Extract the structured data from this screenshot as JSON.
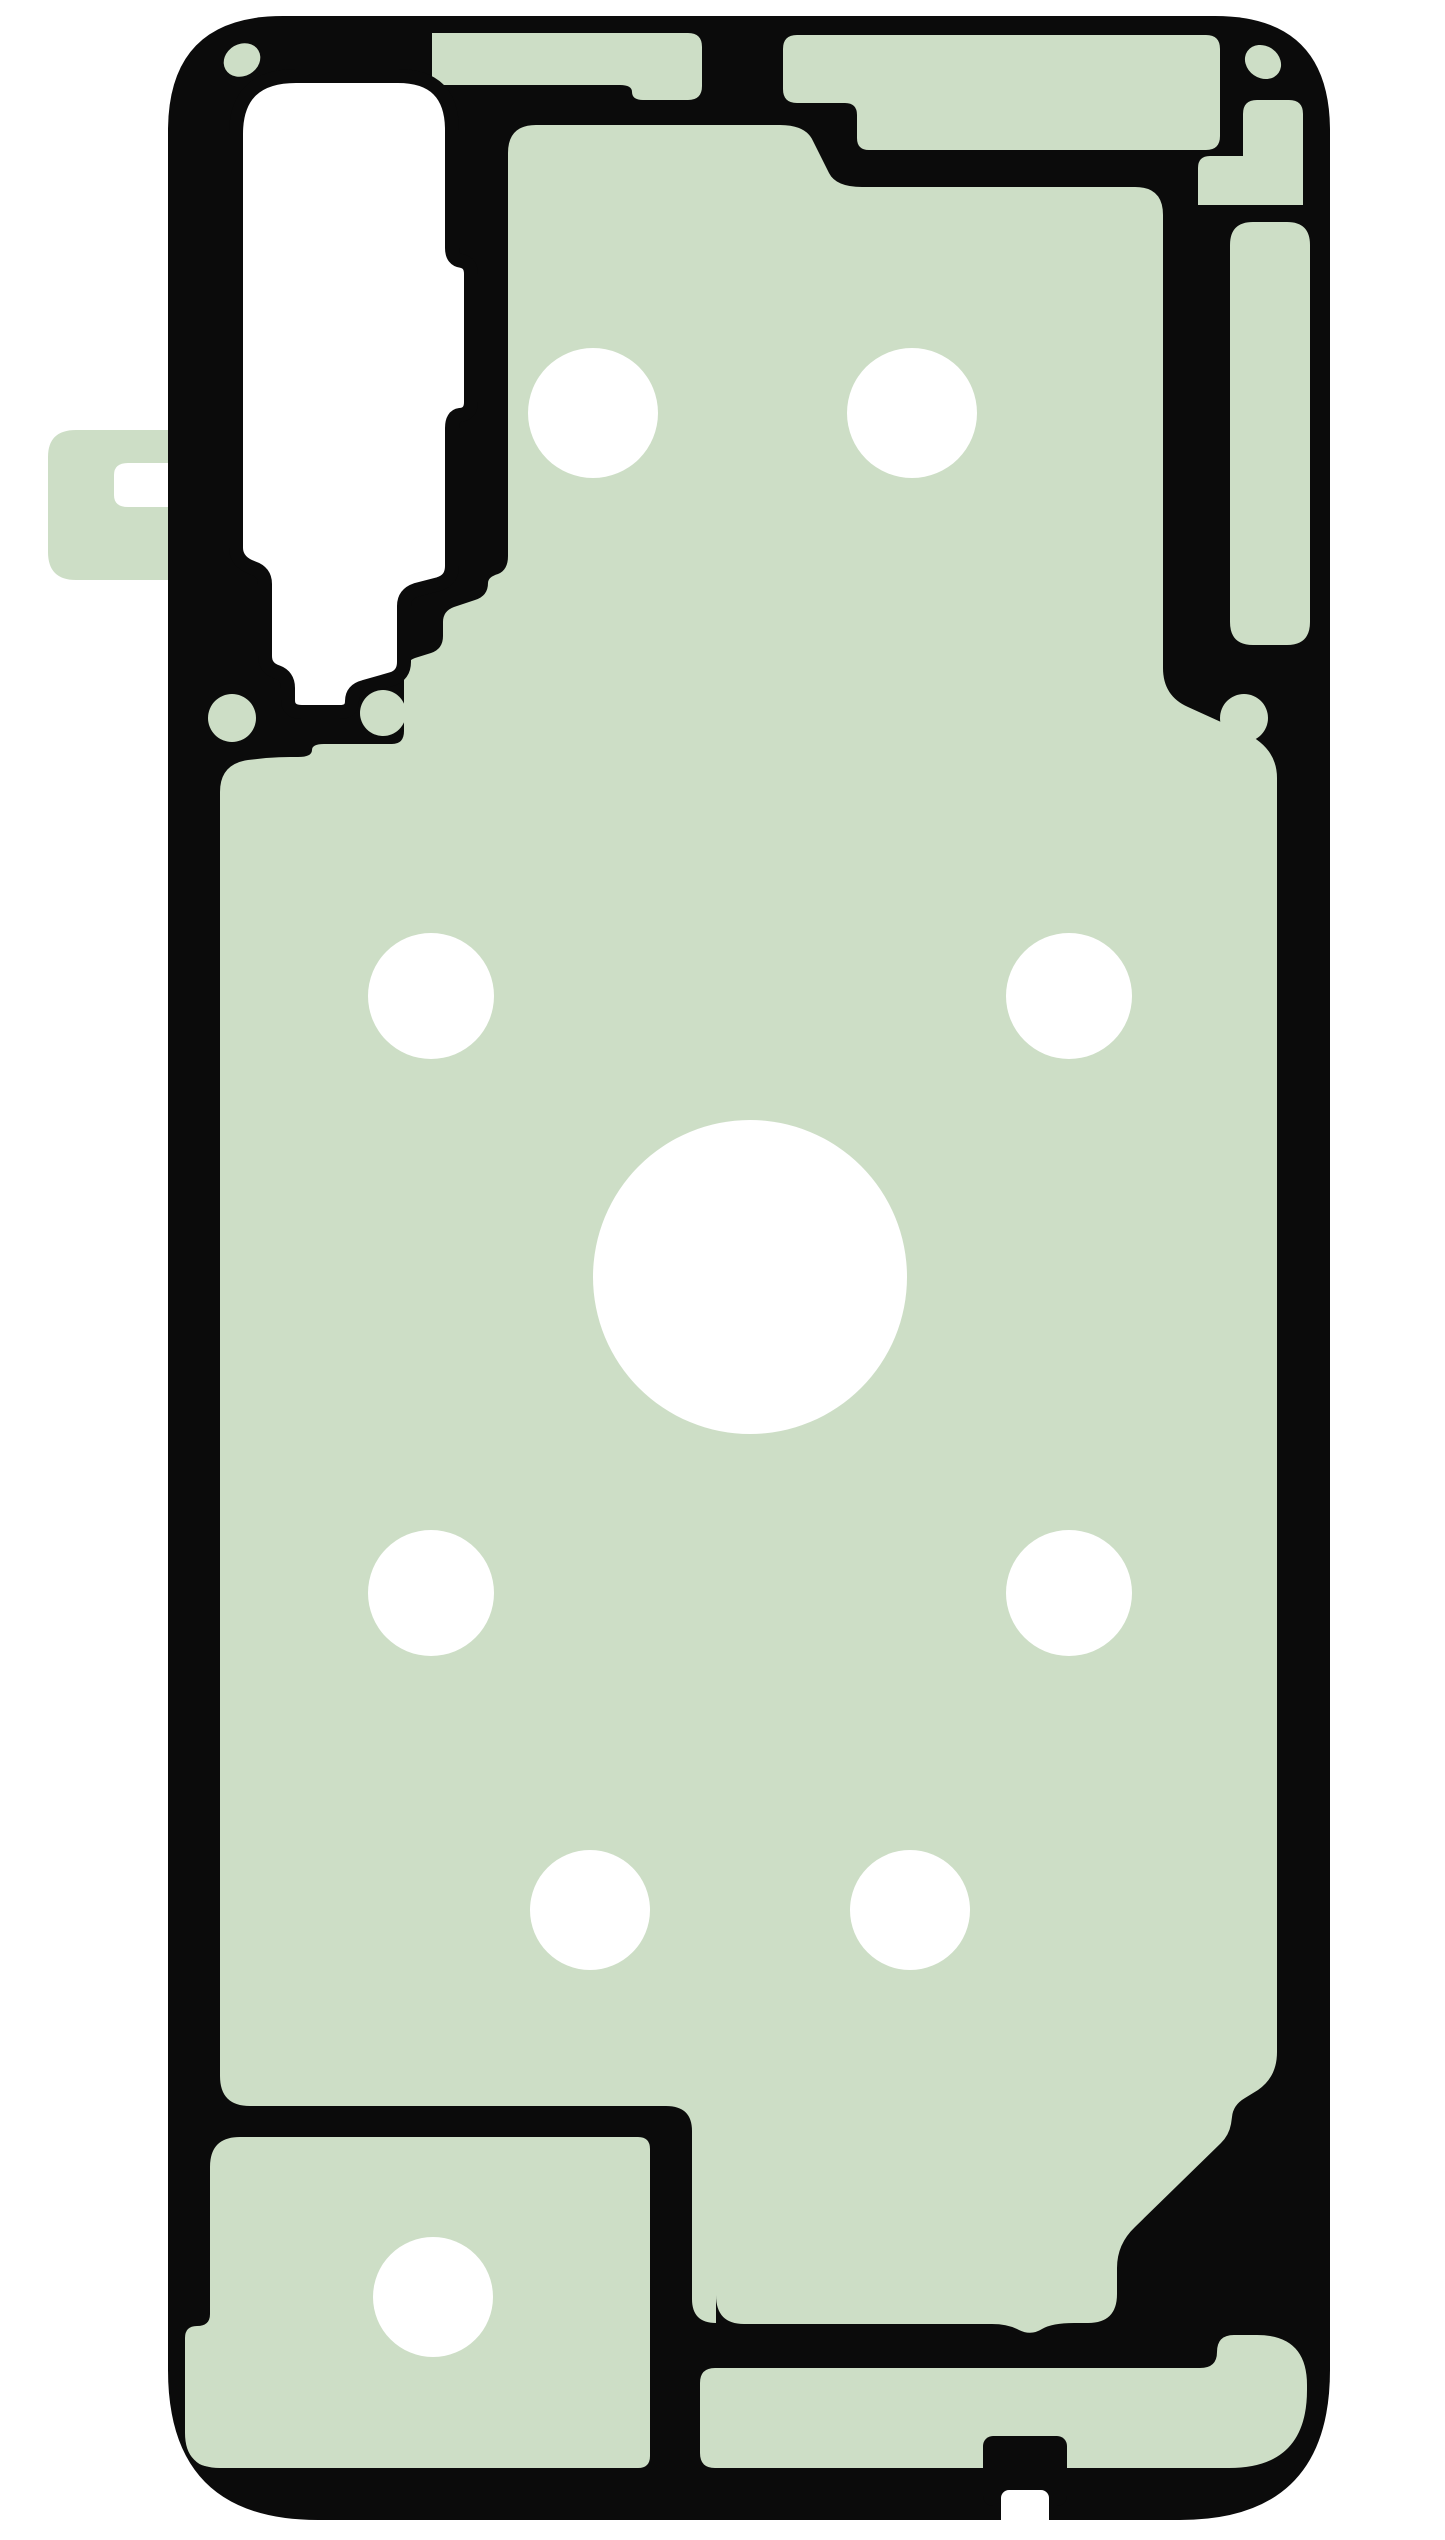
{
  "scene": {
    "description": "Product photo of a die-cut adhesive gasket sticker for a smartphone back cover, sage green with black outline contours, white punched holes, on plain white background",
    "canvas": {
      "width": 1445,
      "height": 2540
    }
  },
  "colors": {
    "background": "#ffffff",
    "adhesive_green": "#cddec6",
    "outline_black": "#0b0b0b",
    "hole_white": "#ffffff"
  },
  "layers": [
    {
      "name": "outer-silhouette",
      "type": "path",
      "fill": "#0b0b0b",
      "d": "M168,131 Q168,16 283,16 H1215 Q1330,16 1330,131 V2370 Q1330,2520 1180,2520 H318 Q168,2520 168,2370 Z"
    },
    {
      "name": "pull-tab",
      "type": "path",
      "fill": "#cddec6",
      "d": "M48,457 Q48,430 76,430 H168 V463 H128 Q114,463 114,475 V495 Q114,507 128,507 H168 V580 H76 Q48,580 48,552 Z"
    },
    {
      "name": "top-strip-left",
      "type": "path",
      "fill": "#cddec6",
      "d": "M432,33 H688 Q702,33 702,47 V86 Q702,100 688,100 H643 Q632,100 632,92 Q632,85 620,85 H432 Z"
    },
    {
      "name": "top-strip-right",
      "type": "path",
      "fill": "#cddec6",
      "d": "M797,35 H1206 Q1220,35 1220,49 V136 Q1220,150 1206,150 H869 Q857,150 857,138 V115 Q857,103 845,103 H797 Q783,103 783,89 V49 Q783,35 797,35 Z"
    },
    {
      "name": "right-strip-upper",
      "type": "path",
      "fill": "#cddec6",
      "d": "M1198,205 V168 Q1198,156 1210,156 H1243 V114 Q1243,100 1257,100 H1289 Q1303,100 1303,114 V205 Z"
    },
    {
      "name": "right-strip",
      "type": "path",
      "fill": "#cddec6",
      "d": "M1230,245 Q1230,222 1253,222 H1287 Q1310,222 1310,245 V622 Q1310,645 1287,645 H1253 Q1230,645 1230,622 Z"
    },
    {
      "name": "main-panel",
      "type": "path",
      "fill": "#cddec6",
      "d": "M536,125 H780 Q806,125 813,141 L829,173 Q836,187 862,187 H1135 Q1163,187 1163,215 V668 Q1163,696 1188,707 L1243,732 Q1277,747 1277,778 V2052 Q1277,2077 1258,2090 L1245,2098 Q1233,2105 1232,2117 L1231,2124 Q1229,2135 1221,2143 L1135,2227 Q1117,2244 1117,2268 V2294 Q1117,2323 1088,2323 H1074 Q1052,2323 1042,2329 Q1031,2336 1019,2330 Q1008,2324 992,2324 H744 Q716,2324 716,2295 L716,2323 Q692,2323 692,2299 V2131 Q692,2106 666,2106 H288 Q258,2106 250,2106 Q220,2106 220,2076 V792 Q220,764 248,760 L266,758 Q280,757 290,757 H298 Q312,757 312,750 Q312,744 324,744 H392 Q404,744 404,731 V674 Q404,662 415,658 L431,653 Q443,649 443,636 V622 Q443,611 454,607 L475,600 Q488,596 488,583 Q488,577 498,574 Q508,570 508,556 V153 Q508,125 536,125 Z"
    },
    {
      "name": "bottom-left-section",
      "type": "path",
      "fill": "#cddec6",
      "d": "M240,2137 H638 Q650,2137 650,2149 V2456 Q650,2468 638,2468 H220 Q185,2468 185,2433 V2338 Q185,2326 197,2326 Q210,2326 210,2314 V2167 Q210,2137 240,2137 Z"
    },
    {
      "name": "bottom-strip-and-corner",
      "type": "path",
      "fill": "#cddec6",
      "d": "M715,2368 H1200 Q1217,2368 1217,2352 Q1217,2335 1234,2335 H1257 Q1307,2335 1307,2385 V2390 Q1307,2468 1229,2468 H715 Q700,2468 700,2453 V2383 Q700,2368 715,2368 Z"
    },
    {
      "name": "bottom-edge-bump",
      "type": "rect",
      "fill": "#0b0b0b",
      "x": 983,
      "y": 2436,
      "w": 84,
      "h": 70,
      "rx": 10
    },
    {
      "name": "camera-cutout",
      "type": "path",
      "fill": "#ffffff",
      "stroke": "#0b0b0b",
      "strokeWidth": 14,
      "d": "M296,76 H398 Q452,76 452,130 V248 Q452,260 462,261 Q471,263 471,274 V402 Q471,414 460,415 Q452,416 452,428 V566 Q452,580 439,584 L416,590 Q404,594 404,606 V662 Q404,675 392,679 L364,687 Q352,690 352,701 Q352,712 340,712 H302 Q288,712 288,700 V688 Q288,676 277,672 Q265,668 265,656 V584 Q265,572 253,568 Q236,562 236,548 V134 Q236,76 296,76 Z"
    },
    {
      "name": "hole-top-left",
      "type": "circle",
      "fill": "#ffffff",
      "cx": 593,
      "cy": 413,
      "r": 65
    },
    {
      "name": "hole-top-right",
      "type": "circle",
      "fill": "#ffffff",
      "cx": 912,
      "cy": 413,
      "r": 65
    },
    {
      "name": "hole-mid-upper-left",
      "type": "circle",
      "fill": "#ffffff",
      "cx": 431,
      "cy": 996,
      "r": 63
    },
    {
      "name": "hole-mid-upper-right",
      "type": "circle",
      "fill": "#ffffff",
      "cx": 1069,
      "cy": 996,
      "r": 63
    },
    {
      "name": "hole-center-large",
      "type": "circle",
      "fill": "#ffffff",
      "cx": 750,
      "cy": 1277,
      "r": 157
    },
    {
      "name": "hole-mid-lower-left",
      "type": "circle",
      "fill": "#ffffff",
      "cx": 431,
      "cy": 1593,
      "r": 63
    },
    {
      "name": "hole-mid-lower-right",
      "type": "circle",
      "fill": "#ffffff",
      "cx": 1069,
      "cy": 1593,
      "r": 63
    },
    {
      "name": "hole-lower-left",
      "type": "circle",
      "fill": "#ffffff",
      "cx": 590,
      "cy": 1910,
      "r": 60
    },
    {
      "name": "hole-lower-right",
      "type": "circle",
      "fill": "#ffffff",
      "cx": 910,
      "cy": 1910,
      "r": 60
    },
    {
      "name": "hole-bottom-left",
      "type": "circle",
      "fill": "#ffffff",
      "cx": 433,
      "cy": 2297,
      "r": 60
    },
    {
      "name": "bottom-edge-slot",
      "type": "rect",
      "fill": "#ffffff",
      "x": 1001,
      "y": 2490,
      "w": 48,
      "h": 52,
      "rx": 8
    },
    {
      "name": "corner-dot-top-left",
      "type": "ellipse",
      "fill": "#cddec6",
      "cx": 242,
      "cy": 60,
      "rx": 19,
      "ry": 16,
      "rotate": -30
    },
    {
      "name": "corner-dot-top-right",
      "type": "ellipse",
      "fill": "#cddec6",
      "cx": 1263,
      "cy": 62,
      "rx": 19,
      "ry": 16,
      "rotate": 35
    },
    {
      "name": "corner-dot-bottom-left",
      "type": "ellipse",
      "fill": "#cddec6",
      "cx": 205,
      "cy": 2452,
      "rx": 16,
      "ry": 13,
      "rotate": 40
    },
    {
      "name": "camera-dot-left",
      "type": "circle",
      "fill": "#cddec6",
      "cx": 232,
      "cy": 718,
      "r": 24
    },
    {
      "name": "camera-dot-right",
      "type": "circle",
      "fill": "#cddec6",
      "cx": 383,
      "cy": 713,
      "r": 23
    },
    {
      "name": "right-side-dot",
      "type": "circle",
      "fill": "#cddec6",
      "cx": 1244,
      "cy": 718,
      "r": 24
    }
  ]
}
